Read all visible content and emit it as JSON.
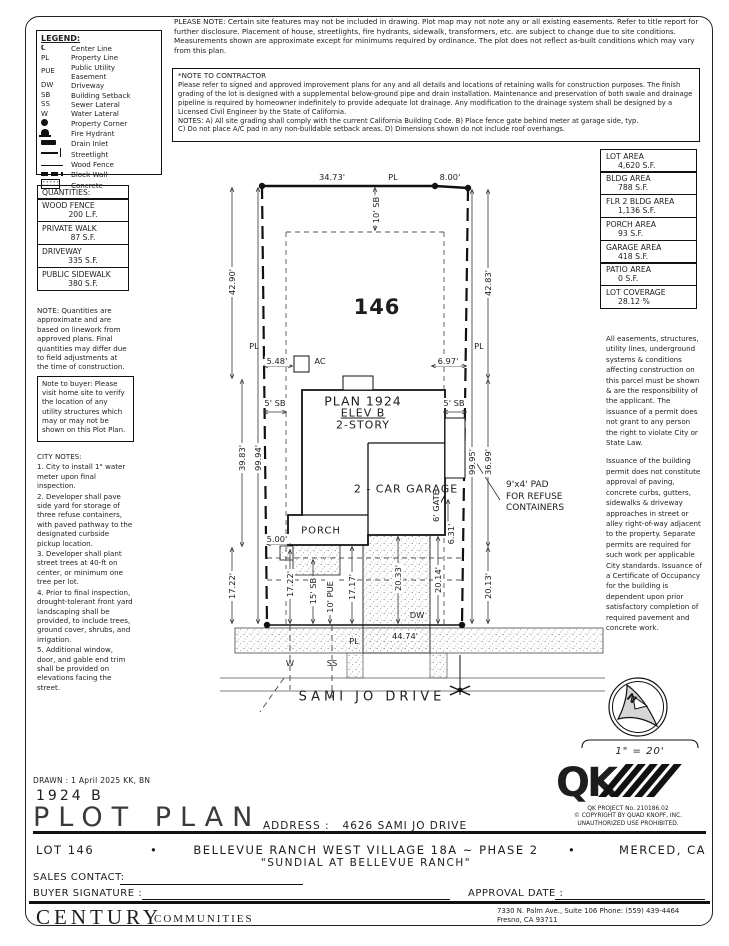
{
  "colors": {
    "ink": "#1d1d1d",
    "paper": "#ffffff",
    "speckle": "#8a8a8a"
  },
  "notes": {
    "please_note": "PLEASE NOTE:  Certain site features may not be included in drawing. Plot map may not note any or all existing easements. Refer to title report for further disclosure. Placement of house, streetlights, fire hydrants, sidewalk, transformers, etc. are subject to change due to site conditions. Measurements shown are approximate except for minimums required by ordinance. The plot does not reflect as-built conditions which may vary from this plan.",
    "contractor_title": "*NOTE TO CONTRACTOR",
    "contractor_body": "Please refer to signed and approved improvement plans for any and all details and locations of retaining walls for construction purposes. The finish grading of the lot is designed with a supplemental below-ground pipe and drain installation. Maintenance and preservation of both swale and drainage pipeline is required by homeowner indefinitely to provide adequate lot drainage. Any modification to the drainage system shall be designed by a Licensed Civil Engineer by the State of California.\nNOTES:  A) All site grading shall comply with the current California Building Code.  B) Place fence gate behind meter at garage side, typ.\nC) Do not place A/C pad in any non-buildable setback areas.  D) Dimensions shown do not include roof overhangs.",
    "quantities_note": "NOTE: Quantities are approximate and are based on linework from approved plans.  Final quantities may differ due to field adjustments at the time of construction.",
    "buyer_note": "Note to buyer: Please visit home site to verify the location of any utility structures which may or may not be shown on this Plot Plan.",
    "easement_1": "All easements, structures, utility lines, underground systems & conditions affecting construction on this parcel must be shown & are the responsibility of the applicant. The issuance of a permit does not grant to any person the right to violate City or State Law.",
    "easement_2": "Issuance of the building permit does not constitute approval of paving, concrete curbs, gutters, sidewalks & driveway approaches in street or alley right-of-way adjacent to the property. Separate permits are required for such work per applicable City standards. Issuance of a Certificate of Occupancy for the building is dependent upon prior satisfactory completion of required pavement and concrete work."
  },
  "legend": {
    "title": "LEGEND:",
    "items": [
      {
        "symbol": "℄",
        "label": "Center Line"
      },
      {
        "symbol": "PL",
        "label": "Property Line"
      },
      {
        "symbol": "PUE",
        "label": "Public Utility\nEasement"
      },
      {
        "symbol": "DW",
        "label": "Driveway"
      },
      {
        "symbol": "SB",
        "label": "Building Setback"
      },
      {
        "symbol": "SS",
        "label": "Sewer Lateral"
      },
      {
        "symbol": "W",
        "label": "Water Lateral"
      },
      {
        "symbol": "",
        "icon": "property-corner",
        "label": "Property Corner"
      },
      {
        "symbol": "",
        "icon": "fire-hydrant",
        "label": "Fire Hydrant"
      },
      {
        "symbol": "",
        "icon": "drain-inlet",
        "label": "Drain Inlet"
      },
      {
        "symbol": "",
        "icon": "streetlight",
        "label": "Streetlight"
      },
      {
        "symbol": "",
        "icon": "wood-fence",
        "label": "Wood Fence"
      },
      {
        "symbol": "",
        "icon": "block-wall",
        "label": "Block Wall"
      },
      {
        "symbol": "",
        "icon": "concrete",
        "label": "Concrete"
      }
    ]
  },
  "quantities": {
    "title": "QUANTITIES:",
    "items": [
      {
        "label": "WOOD FENCE",
        "value": "200 L.F."
      },
      {
        "label": "PRIVATE WALK",
        "value": "87 S.F."
      },
      {
        "label": "DRIVEWAY",
        "value": "335 S.F."
      },
      {
        "label": "PUBLIC SIDEWALK",
        "value": "380 S.F."
      }
    ]
  },
  "city_notes": {
    "title": "CITY NOTES:",
    "items": [
      "1. City to install 1\" water meter upon final inspection.",
      "2. Developer shall pave side yard for storage of three refuse containers, with paved pathway to the designated curbside pickup location.",
      "3. Developer shall plant street trees at 40-ft on center, or minimum one tree per lot.",
      "4. Prior to final inspection, drought-tolerant front yard landscaping shall be provided, to include trees, ground cover, shrubs, and irrigation.",
      "5. Additional window, door, and gable end trim shall be provided on elevations facing the street."
    ]
  },
  "areas": {
    "items": [
      {
        "label": "LOT AREA",
        "value": "4,620 S.F."
      },
      {
        "label": "BLDG AREA",
        "value": "788 S.F."
      },
      {
        "label": "FLR 2 BLDG AREA",
        "value": "1,136 S.F."
      },
      {
        "label": "PORCH AREA",
        "value": "93 S.F."
      },
      {
        "label": "GARAGE AREA",
        "value": "418 S.F."
      },
      {
        "label": "PATIO AREA",
        "value": "0 S.F."
      },
      {
        "label": "LOT COVERAGE",
        "value": "28.12 %"
      }
    ]
  },
  "plot": {
    "lot_number": "146",
    "plan_line1": "PLAN 1924",
    "plan_line2": "ELEV B",
    "plan_line3": "2-STORY",
    "garage": "2 - CAR\nGARAGE",
    "porch": "PORCH",
    "street": "SAMI JO DRIVE",
    "refuse_note": "9'x4' PAD\nFOR REFUSE\nCONTAINERS",
    "dims": {
      "rear_seg1": "34.73'",
      "pl_top": "PL",
      "rear_seg2": "8.00'",
      "left_upper": "42.90'",
      "left_mid": "39.83'",
      "left_total": "99.94'",
      "left_front": "17.22'",
      "right_upper": "42.83'",
      "right_total": "99.95'",
      "right_mid": "36.99'",
      "right_front_inner": "20.14'",
      "right_front_outer": "20.13'",
      "rear_sb": "10' SB",
      "side_sb_left": "5' SB",
      "side_sb_right": "5' SB",
      "ac_left": "5.48'",
      "ac": "AC",
      "ac_right": "6.97'",
      "porch_offset": "5.00'",
      "front_inner": "17.22'",
      "front_sb": "15' SB",
      "pue": "10' PUE",
      "walk_depth": "17.17'",
      "drive_depth": "20.33'",
      "gate": "6' GATE",
      "gate_offset": "6.31'",
      "dw": "DW",
      "front_width": "44.74'",
      "pl_left": "PL",
      "pl_right": "PL",
      "pl_bottom": "PL",
      "water": "W",
      "sewer": "SS"
    }
  },
  "compass": {
    "letter": "N"
  },
  "scale_text": "1\" = 20'",
  "titleblock": {
    "drawn": "DRAWN :  1 April 2025  KK, BN",
    "plan_code": "1924  B",
    "sheet_title": "PLOT PLAN",
    "address_label": "ADDRESS :",
    "address": "4626 SAMI JO DRIVE"
  },
  "qk": {
    "mark": "QK",
    "project": "QK PROJECT No. 210186.02",
    "copyright": "© COPYRIGHT BY QUAD KNOPF, INC.",
    "unauthorized": "UNAUTHORIZED USE PROHIBITED."
  },
  "project_strip": {
    "lot": "LOT 146",
    "bullet": "•",
    "subdivision": "BELLEVUE RANCH WEST VILLAGE 18A ~ PHASE 2",
    "city": "MERCED, CA",
    "community": "\"SUNDIAL AT BELLEVUE RANCH\"",
    "sales_contact": "SALES CONTACT:",
    "buyer_signature": "BUYER SIGNATURE :",
    "approval_date": "APPROVAL DATE :"
  },
  "brand": {
    "name": "CENTURY",
    "suffix": "COMMUNITIES",
    "address_line1": "7330 N. Palm Ave., Suite 106    Phone:  (559) 439-4464",
    "address_line2": "Fresno, CA  93711"
  }
}
